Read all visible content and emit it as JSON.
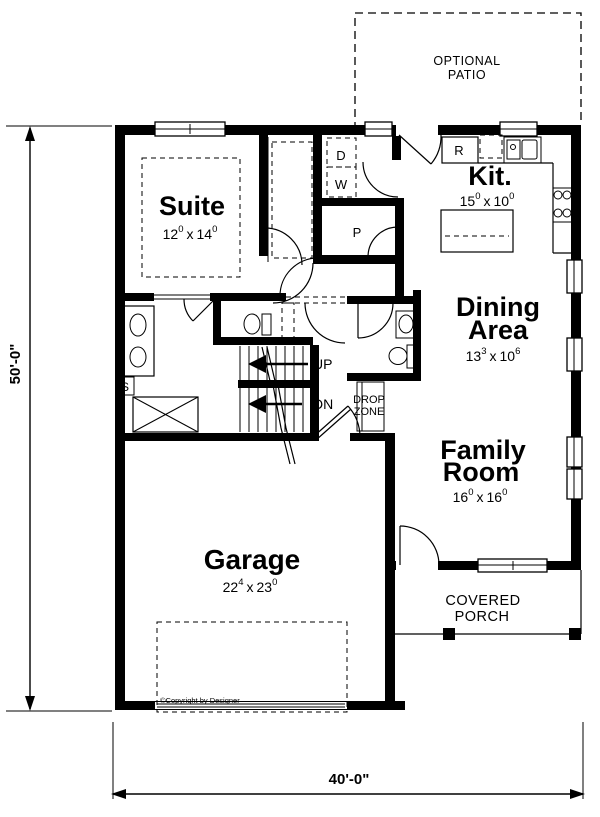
{
  "rooms": {
    "optional_patio": {
      "line1": "OPTIONAL",
      "line2": "PATIO"
    },
    "suite": {
      "label": "Suite",
      "dim": {
        "a": "12",
        "a_sup": "0",
        "sep": "x",
        "b": "14",
        "b_sup": "0"
      }
    },
    "kitchen": {
      "label": "Kit.",
      "dim": {
        "a": "15",
        "a_sup": "0",
        "sep": "x",
        "b": "10",
        "b_sup": "0"
      }
    },
    "dining": {
      "label_line1": "Dining",
      "label_line2": "Area",
      "dim": {
        "a": "13",
        "a_sup": "3",
        "sep": "x",
        "b": "10",
        "b_sup": "6"
      }
    },
    "family": {
      "label_line1": "Family",
      "label_line2": "Room",
      "dim": {
        "a": "16",
        "a_sup": "0",
        "sep": "x",
        "b": "16",
        "b_sup": "0"
      }
    },
    "garage": {
      "label": "Garage",
      "dim": {
        "a": "22",
        "a_sup": "4",
        "sep": "x",
        "b": "23",
        "b_sup": "0"
      }
    },
    "covered_porch": {
      "line1": "COVERED",
      "line2": "PORCH"
    }
  },
  "annotations": {
    "up": "UP",
    "down": "DN",
    "drop_zone_line1": "DROP",
    "drop_zone_line2": "ZONE",
    "dryer": "D",
    "washer": "W",
    "pantry": "P",
    "range": "R",
    "shower": "S",
    "copyright": "©Copyright by Designer"
  },
  "dimensions": {
    "height": "50'-0\"",
    "width": "40'-0\""
  },
  "colors": {
    "wall": "#000000",
    "line": "#000000",
    "background": "#ffffff"
  }
}
